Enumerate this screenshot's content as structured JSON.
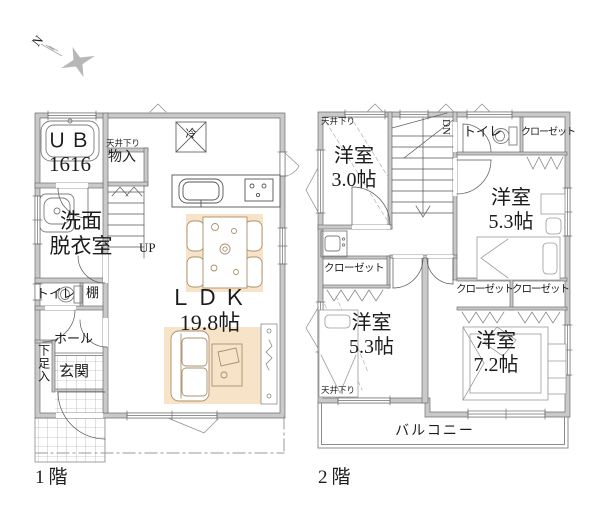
{
  "compass": {
    "north": "N"
  },
  "floor1": {
    "caption": "1階",
    "unit_bath": "ＵＢ",
    "unit_bath_size": "1616",
    "ceiling_drop": "天井下り",
    "storage": "物入",
    "stairs_up": "UP",
    "washroom_line1": "洗面",
    "washroom_line2": "脱衣室",
    "toilet": "トイレ",
    "shelf": "棚",
    "hall": "ホール",
    "shoe_storage": "下足入",
    "entrance": "玄関",
    "ldk": "ＬＤＫ",
    "ldk_size": "19.8帖",
    "refrigerator": "冷"
  },
  "floor2": {
    "caption": "2階",
    "ceiling_drop_nw": "天井下り",
    "ceiling_drop_sw": "天井下り",
    "stairs_down": "DN",
    "toilet": "トイレ",
    "closet_ne": "クローゼット",
    "closet_w": "クローゼット",
    "closet_mid_left": "クローゼット",
    "closet_mid_right": "クローゼット",
    "room_nw": "洋室",
    "room_nw_size": "3.0帖",
    "room_ne": "洋室",
    "room_ne_size": "5.3帖",
    "room_sw": "洋室",
    "room_sw_size": "5.3帖",
    "room_se": "洋室",
    "room_se_size": "7.2帖",
    "balcony": "バルコニー"
  },
  "colors": {
    "wall_fill": "#c9c9c9",
    "wall_line": "#6f6f6f",
    "furniture_bg": "#f7e3c7",
    "furniture_line": "#a8906c"
  }
}
